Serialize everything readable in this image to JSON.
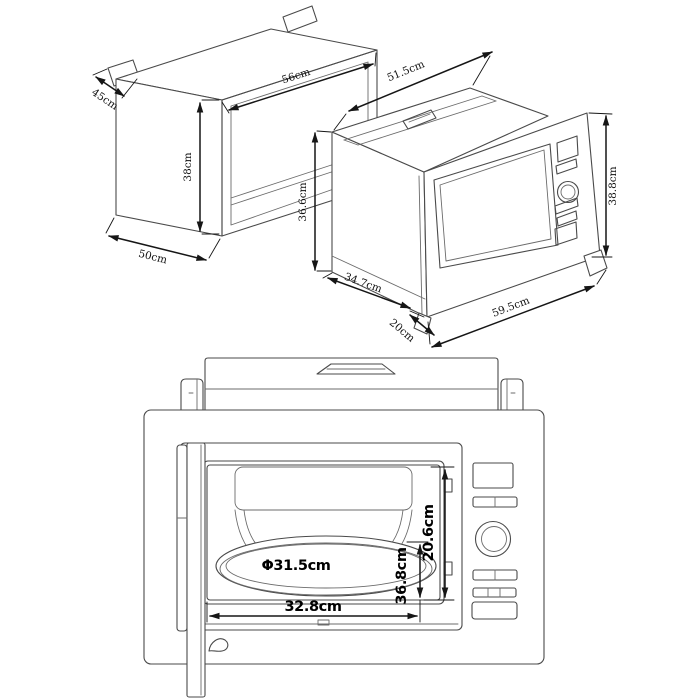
{
  "drawing": {
    "background": "#ffffff",
    "line_color": "#4a4a4a",
    "dimension_color": "#161616"
  },
  "views": {
    "cabinet_iso": {
      "dims": {
        "tab_depth": "45cm",
        "width": "56cm",
        "height": "38cm",
        "depth": "50cm"
      }
    },
    "microwave_iso": {
      "dims": {
        "top_width": "51.5cm",
        "left_height": "36.6cm",
        "bottom_depth": "34.7cm",
        "front_offset": "20cm",
        "front_width": "59.5cm",
        "front_height": "38.8cm"
      }
    },
    "front_view": {
      "dims": {
        "turntable_diameter": "Φ31.5cm",
        "cavity_width": "32.8cm",
        "plate_to_floor_height": "36.8cm",
        "cavity_height": "20.6cm"
      }
    }
  }
}
